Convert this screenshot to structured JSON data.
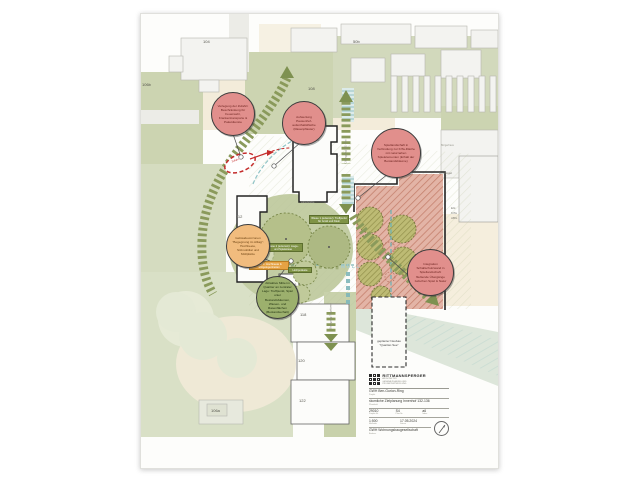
{
  "map": {
    "numbers": [
      "104",
      "106b",
      "50b",
      "108",
      "110",
      "112",
      "114",
      "116",
      "118",
      "120",
      "122",
      "106a"
    ],
    "labels": {
      "zentrum": "Zentrum",
      "am_buegel": "Am Bügel",
      "buergerhaus": "Bürgerhaus",
      "kita_line1": "EG:",
      "kita_line2": "KiTa",
      "kita_line3": "ABG",
      "muell": "MÜLL",
      "uebergang_qe": "Übergang QE Ost",
      "uebergang_tegel": "Übergang Tegelweg",
      "neubau": "geplanter Neubau \"Quartier-See\"",
      "zufahrt": "Zufahrt",
      "rasenkante": "Rasenkante"
    },
    "tags": {
      "wiese1": "Wiese 1 (extensiv): Treffpunkt für Groß und Klein",
      "wiese2": "Wiese 2 (extensiv): Liege- und Spielwiese",
      "platz1": "Platz 1: Hochbeete & Sitzgelegenheiten",
      "holz": "Holzpodeste"
    }
  },
  "bubbles": [
    {
      "id": "zufahrt",
      "color": "#e18f8c",
      "text": "Verlegung der Zufahrt: Beschränkung für Feuerwehr, Krankentransporte & Paketdienste"
    },
    {
      "id": "pausenhof",
      "color": "#e18f8c",
      "text": "Aufwertung Pausenhof- aufenthaltsfläche (Rasenpflaster)"
    },
    {
      "id": "spiellandschaft",
      "color": "#e18f8c",
      "text": "Spiellandschaft in Verbindung zur KiTa-Fläche mit naturnahen Spielelementen (Erhalt der Bestandsbäume)"
    },
    {
      "id": "vorzonen",
      "color": "#f1bc7e",
      "text": "Gebäudevorzonen \"Begegnung im Alltag\": Hochbeete, Sitzmobiliar und Müllplätze"
    },
    {
      "id": "mitte",
      "color": "#9cb06d",
      "text": "Attraktive Mitte im Quartier an zentraler Lage: Treffpunkt, Spiel unter Bestandsbäumen, Wiesen- und Rasenflächen (Bestandserhalt)"
    },
    {
      "id": "schallschutz",
      "color": "#e18f8c",
      "text": "Integration Schallschutzwand in Spiellandschaft: fließende Übergänge zwischen Spiel & Natur"
    }
  ],
  "titleblock": {
    "firm": "RITTMANNSPERGER",
    "firm_sub1": "ARCHITEKTUR",
    "firm_sub2": "GENERALPLANUNG UND",
    "firm_sub3": "PROJEKTENTWICKLUNG",
    "project": "GWH Ben-Gurion-Ring",
    "project_label": "Projekt",
    "plan_title": "räumliche Zielplanung Innenhof 132-136",
    "plan_title_label": "Planinhalt",
    "project_no": "29010",
    "project_no_label": "Projekt-Nr.",
    "plan_no": "S4",
    "plan_no_label": "Plan-Nr.",
    "index": "a6",
    "index_label": "Index",
    "scale": "1:500",
    "scale_label": "Maßstab",
    "date": "17.05.2024",
    "date_label": "Datum",
    "client": "GWH Wohnungsbaugesellschaft",
    "client_label": "Bauherr",
    "north": "N"
  },
  "colors": {
    "path_green": "#8a9a5b",
    "annotation_red": "#e18f8c",
    "annotation_orange": "#f1bc7e",
    "annotation_green": "#9cb06d",
    "play_area": "#e0b1a3",
    "teal": "#7fb7ba",
    "alert_red": "#c42b2b",
    "green_space": "#ccd4b1",
    "tan": "#f3ecda"
  }
}
